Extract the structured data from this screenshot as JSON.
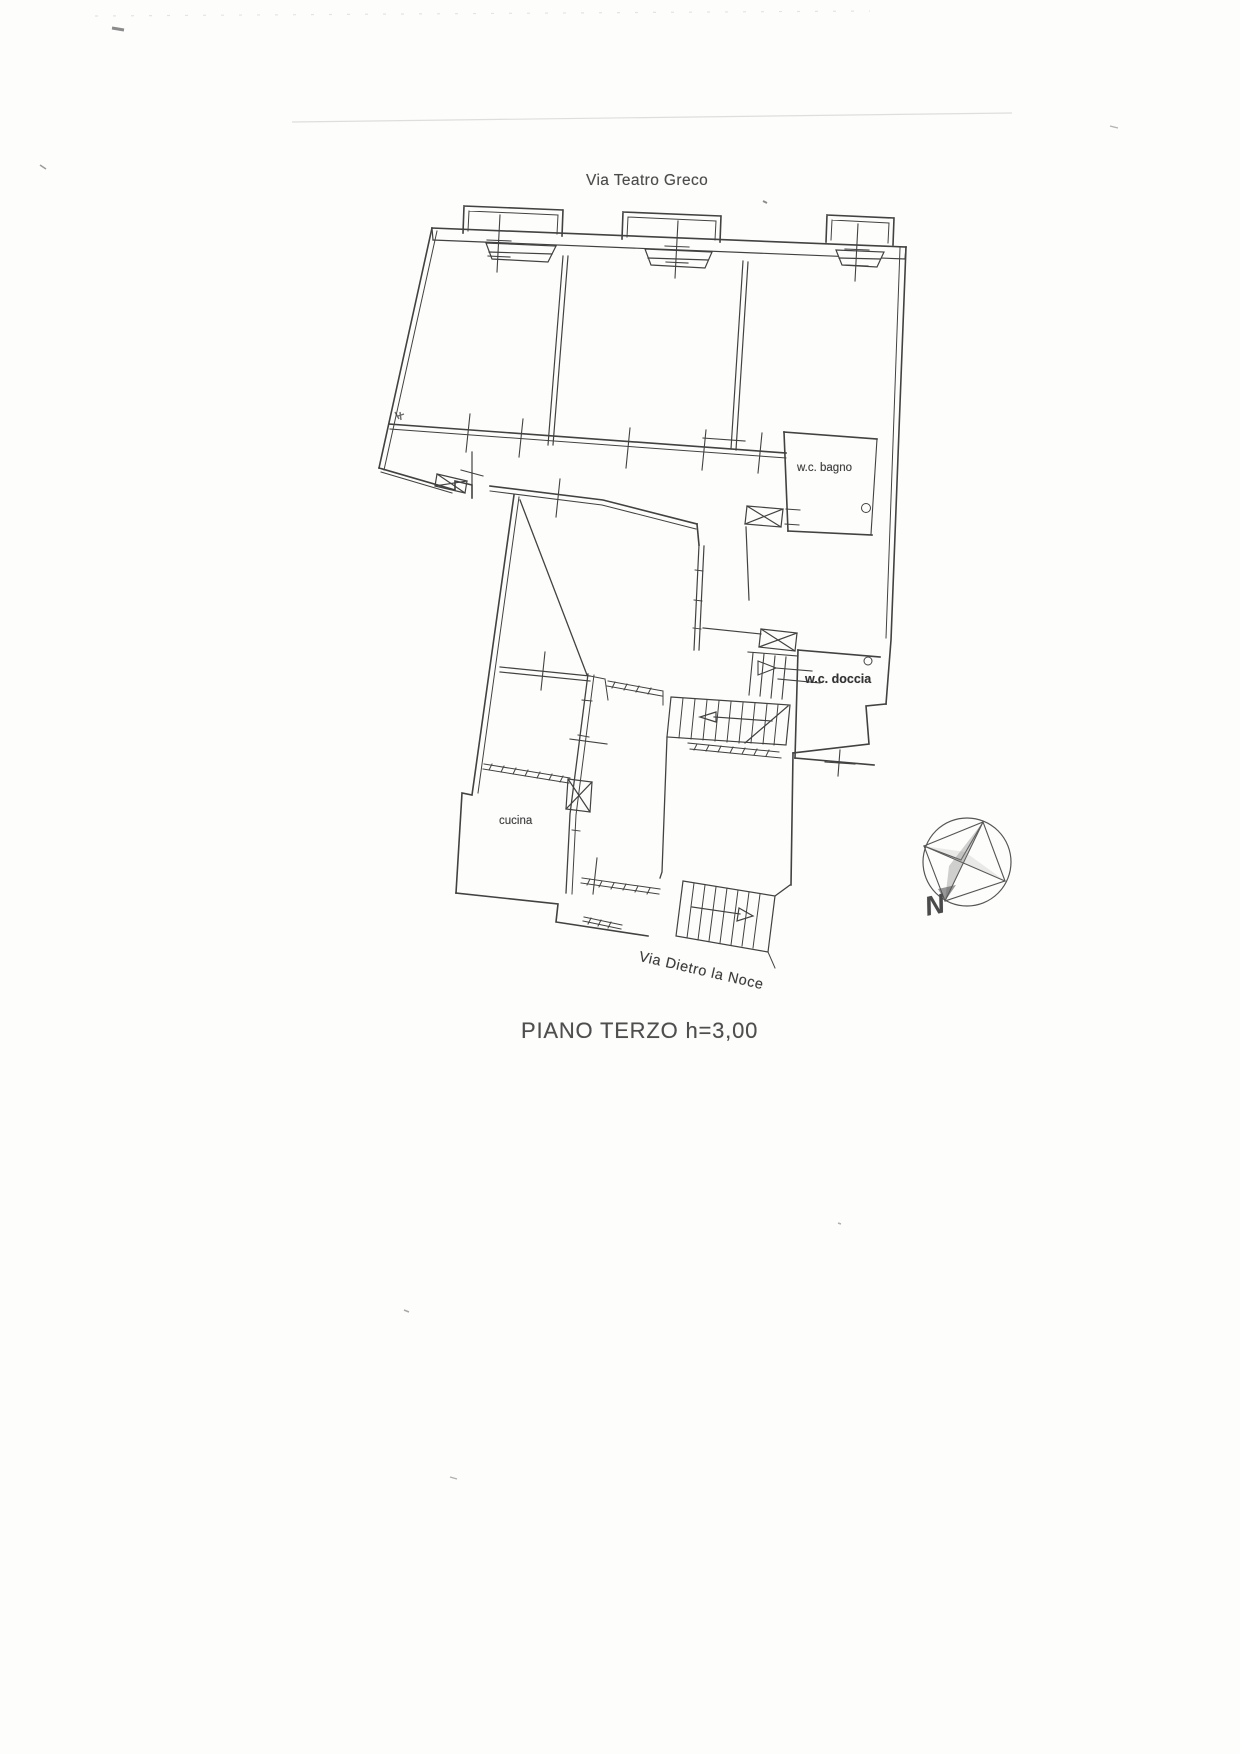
{
  "palette": {
    "paper": "#fdfdfc",
    "ink": "#424242",
    "faint_artifact": "#c9c9c5",
    "label_text": "#474747"
  },
  "plan": {
    "street_top": "Via Teatro Greco",
    "street_bottom": "Via Dietro la Noce",
    "rooms": {
      "bagno": "w.c. bagno",
      "doccia": "w.c. doccia",
      "cucina": "cucina"
    },
    "compass": {
      "north": "N"
    },
    "caption": "PIANO TERZO h=3,00"
  }
}
